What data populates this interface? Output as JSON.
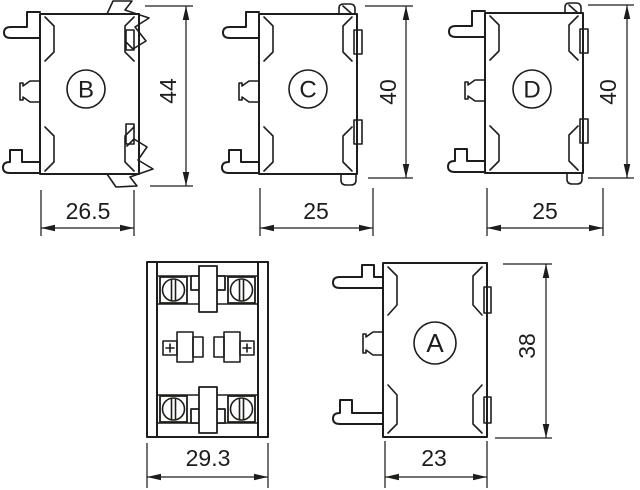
{
  "colors": {
    "line": "#1d1d1b",
    "background": "#ffffff"
  },
  "views": {
    "b": {
      "label": "B",
      "height": "44",
      "width": "26.5"
    },
    "c": {
      "label": "C",
      "height": "40",
      "width": "25"
    },
    "d": {
      "label": "D",
      "height": "40",
      "width": "25"
    },
    "a": {
      "label": "A",
      "height": "38",
      "width": "23"
    },
    "top": {
      "width": "29.3"
    }
  }
}
